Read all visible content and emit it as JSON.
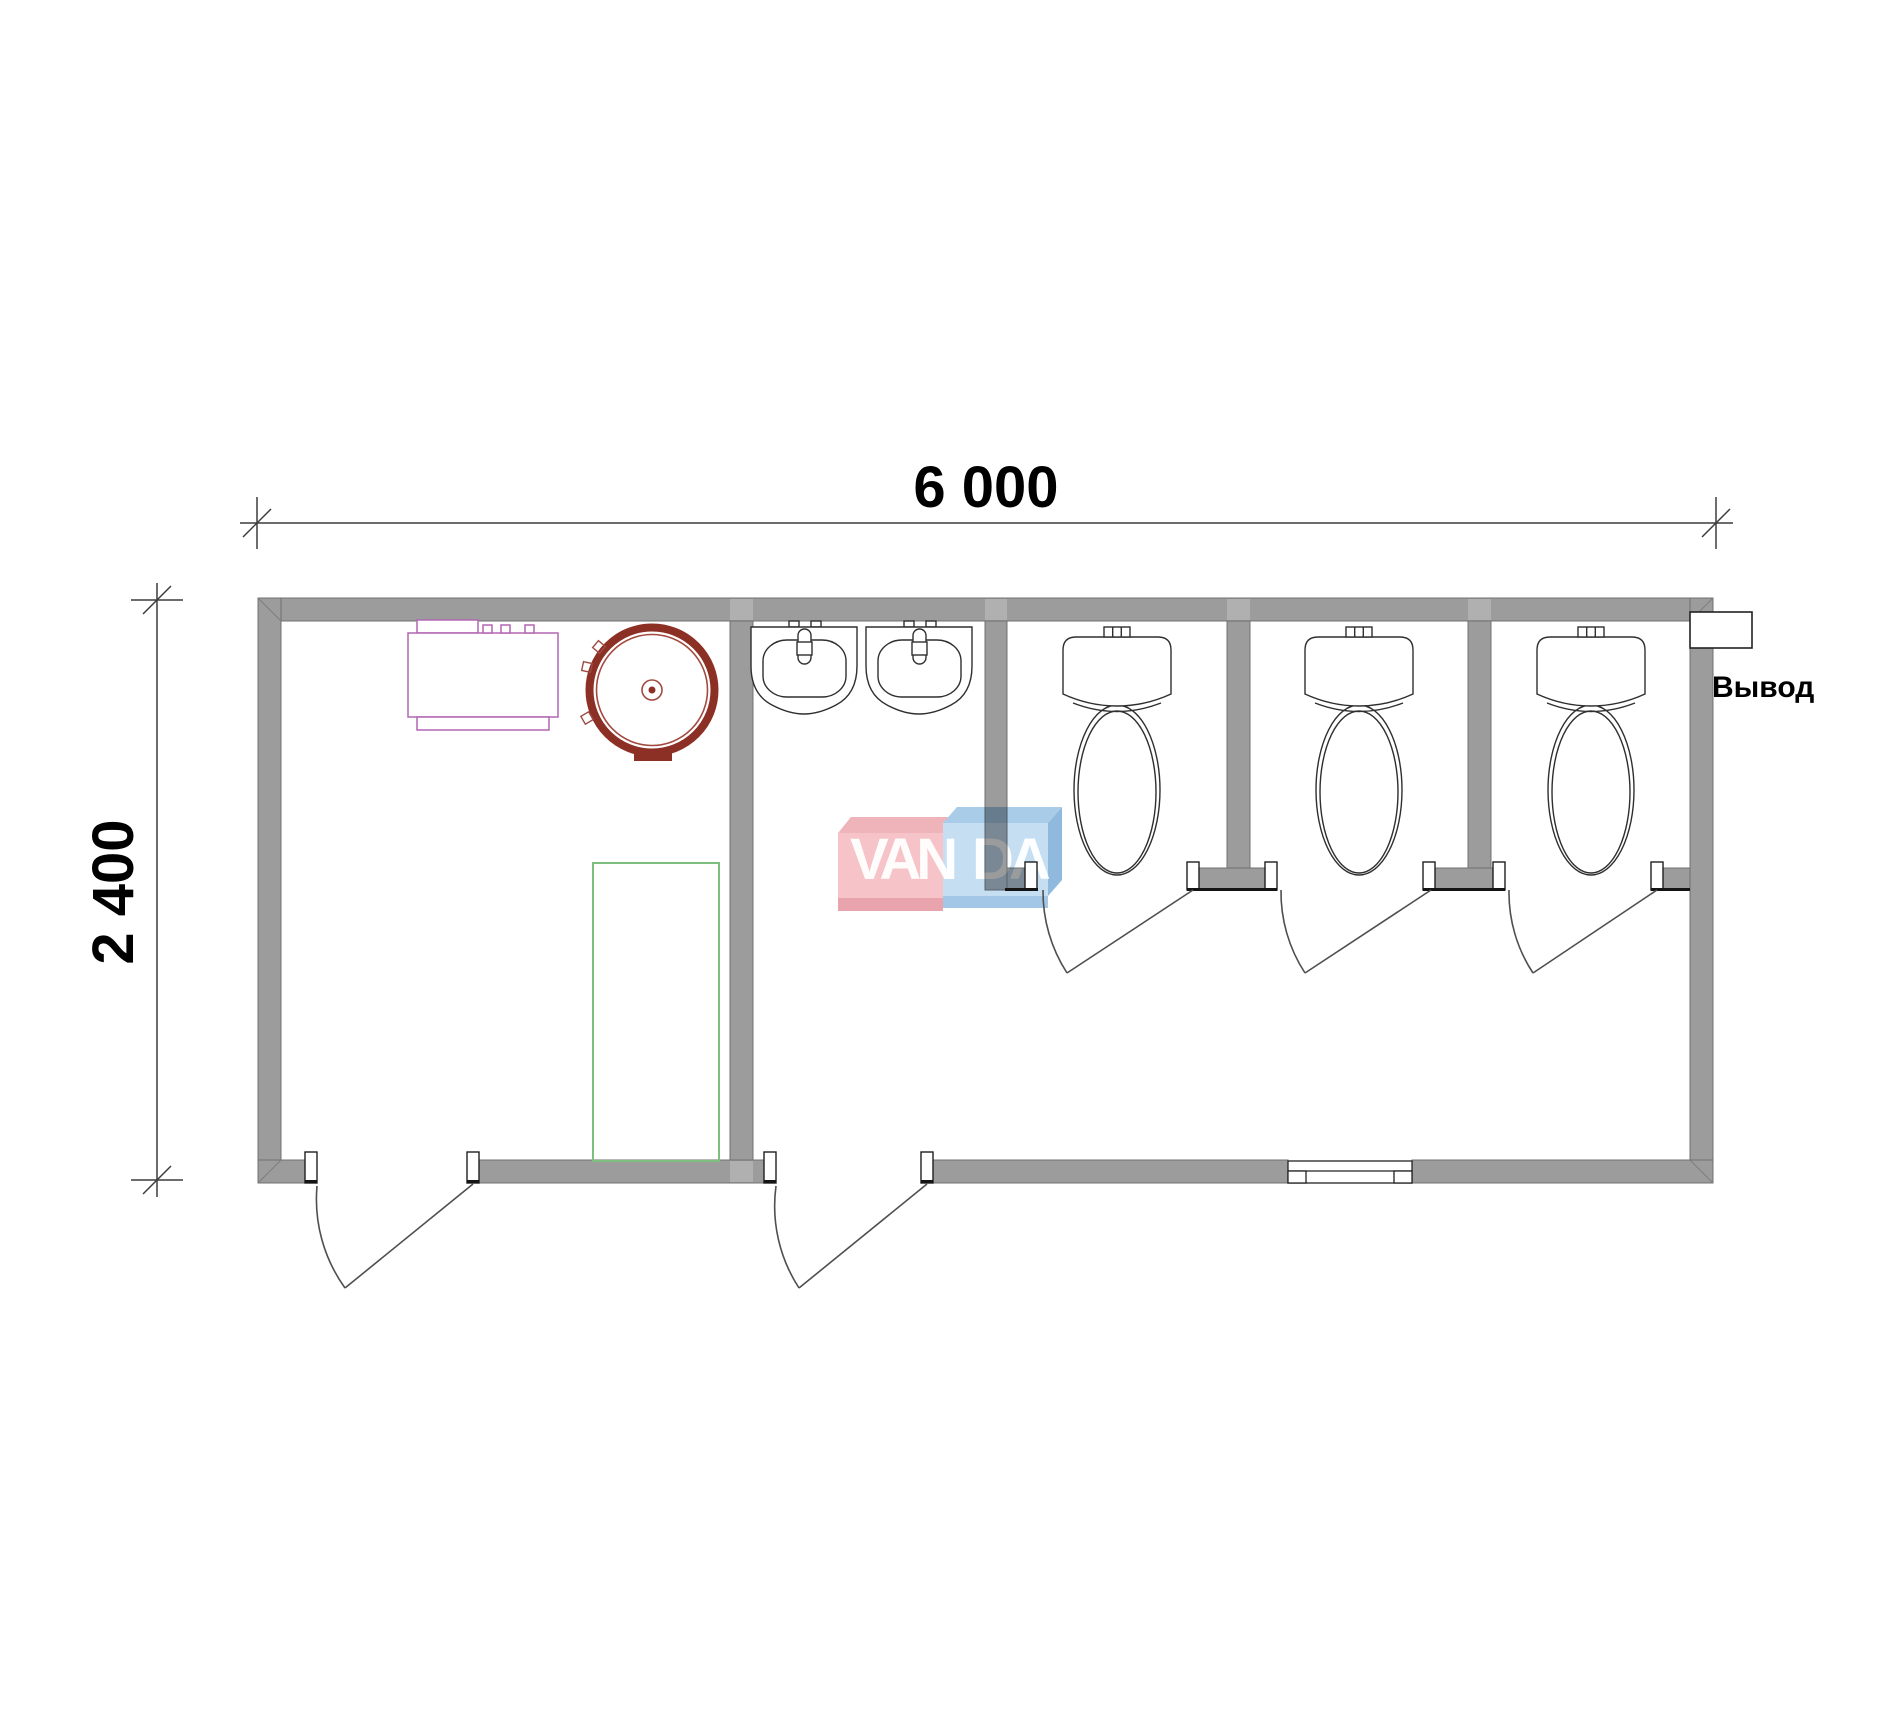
{
  "drawing": {
    "type": "floor-plan",
    "background": "#ffffff"
  },
  "dimensions": {
    "top_label": "6 000",
    "left_label": "2 400"
  },
  "outlet": {
    "label": "Вывод"
  },
  "watermark": {
    "left_text": "VAN",
    "right_text": "DA",
    "full_text": "VANDA"
  },
  "fixtures": {
    "toilet_count": 3,
    "sink_count": 2,
    "shower_tray_count": 1,
    "round_water_tank_count": 1,
    "boiler_unit_count": 1,
    "exterior_door_count": 2,
    "stall_door_count": 3,
    "window_count": 1
  },
  "colors": {
    "wall_gray": "#9c9c9c",
    "wall_seam": "#b0b0b0",
    "line_dark": "#2f2f2f",
    "door_line": "#4f4f4f",
    "dim_line": "#3c3c3c",
    "equipment_purple": "#b266b2",
    "tank_red": "#8c3026",
    "tank_red_thin": "#a34a40",
    "shower_green": "#7dbd7d",
    "watermark_pink_top": "#efb3ba",
    "watermark_pink_main": "#f6c3c8",
    "watermark_pink_shadow": "#e9a3ac",
    "watermark_blue_top": "#a9cde9",
    "watermark_blue_main": "#c5def2",
    "watermark_blue_side": "#8fb9dd",
    "watermark_blue_shadow": "#a3c7e6",
    "text_black": "#000000"
  }
}
